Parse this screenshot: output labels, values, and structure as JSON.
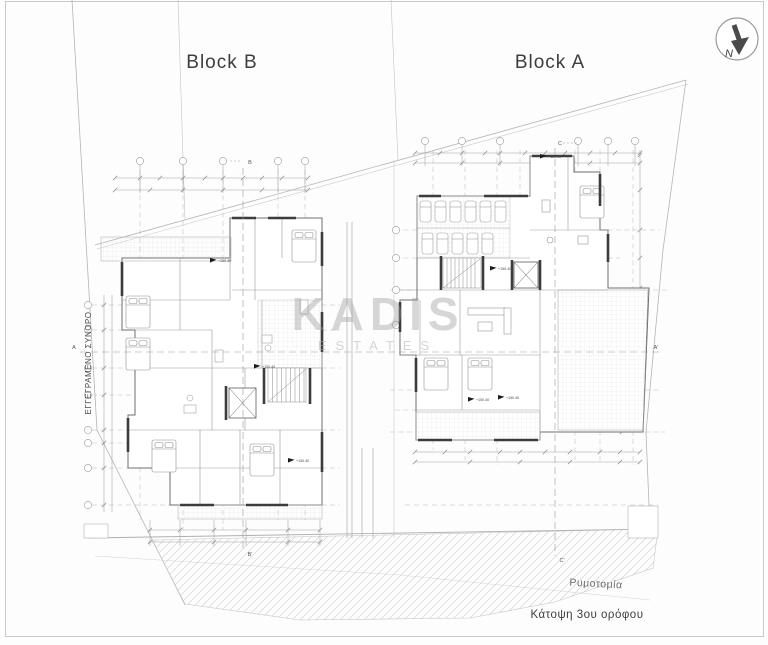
{
  "drawing": {
    "block_b_title": "Block B",
    "block_a_title": "Block A",
    "north_label": "N",
    "watermark_line1": "KADIS",
    "watermark_line2": "ESTATES",
    "boundary_label": "ΕΓΓΕΓΡΑΜΕΝΟ ΣΥΝΟΡΟ",
    "road_label": "Ρυμοτομία",
    "caption": "Κάτοψη 3ου ορόφου",
    "level_marker": "+150.40",
    "section_markers": {
      "a": "A",
      "a2": "A'",
      "b": "B",
      "b2": "B'",
      "c": "C",
      "c2": "C'"
    },
    "colors": {
      "wall": "#3c3c3c",
      "line": "#8f8f8f",
      "watermark": "#a6a6a6",
      "text": "#3d3d3d"
    }
  }
}
